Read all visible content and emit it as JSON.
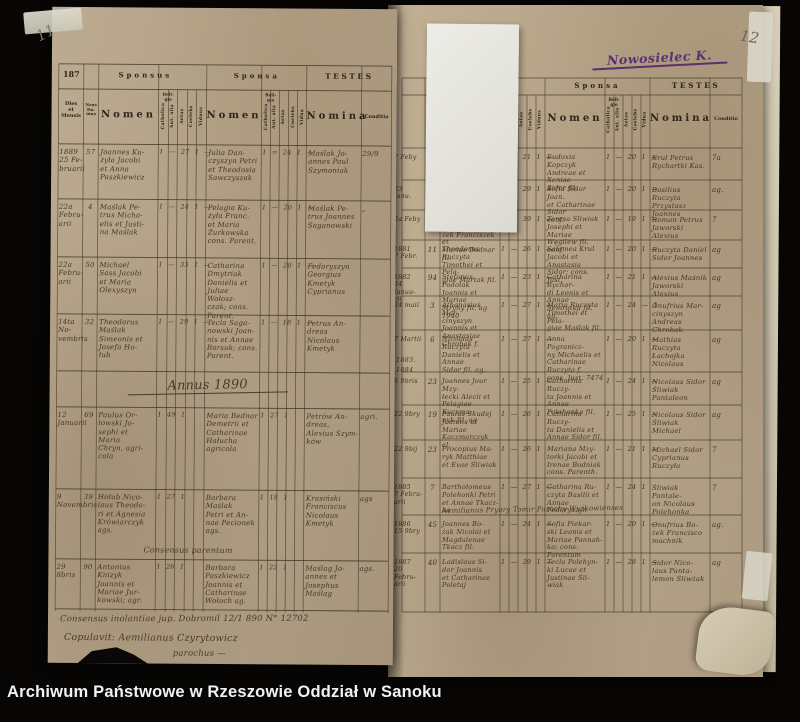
{
  "archive_bar": {
    "text": "Archiwum Państwowe w Rzeszowie Oddział w Sanoku"
  },
  "annotations": {
    "page_number_left": "11",
    "page_number_right": "12",
    "village_note": "Nowosielec K."
  },
  "left_page": {
    "header": {
      "year": "187",
      "sponsus": "Sponsus",
      "sponsa": "Sponsa",
      "testes": "TESTES",
      "dies": "Dies\net\nMensis",
      "nrus": "Nrus\nDo-\nmus",
      "nomen": "Nomen",
      "religio": "Reli-\ngio",
      "nomina": "Nomina",
      "conditio": "Conditio",
      "catholica": "Catholica",
      "aut_alia": "Aut. alia",
      "aetas": "Aetas",
      "coelebs": "Coelebs",
      "viduus": "Viduus",
      "vidua": "Vidua"
    },
    "section_heading": "Annus 1890",
    "rows": [
      {
        "date": "1889\n25 Fe-\nbruarii",
        "house": "57",
        "groom": "Joannes Ku-\nżyła Jacobi\net Anna\nPaszkiewicz",
        "groom_marks": "1 — 27 1 —",
        "bride": "Julia Dan-\nczyszyn Petri\net Theodosia\nSawczyszak",
        "bride_marks": "1 = 24 1 —",
        "witnesses": "Maślak Jo-\nannes Paul\nSzymoniak",
        "conditio": "29/9"
      },
      {
        "date": "22a\nFebru-\narii",
        "house": "4",
        "groom": "Maślak Pe-\ntrus Micha-\nelis et Justi-\nna Maślak",
        "groom_marks": "1 — 24 1 —",
        "bride": "Pelagia Ku-\nżyła Franc.\net Maria\nŻurkowska\ncons. Parent.",
        "bride_marks": "1 — 20 1 —",
        "witnesses": "Maślak Pe-\ntrus Joannes\nSaganowski",
        "conditio": "„"
      },
      {
        "date": "22a\nFebru-\narii",
        "house": "50",
        "groom": "Michael\nSass Jacobi\net Maria\nOlexyszyn",
        "groom_marks": "1 — 33 1 —",
        "bride": "Catharina\nDmytriak\nDanielis et\nJuliae Wołosz-\nczak; cons. Parent.",
        "bride_marks": "1 — 20 1 —",
        "witnesses": "Fedoryszyn\nGeorgius\nKmetyk\nCyprianus",
        "conditio": ""
      },
      {
        "date": "14ta No-\nvembris",
        "house": "32",
        "groom": "Theodorus\nMaślak\nSimeonis et\nJosefa Ho-\nłub",
        "groom_marks": "1 — 29 1 —",
        "bride": "Tecla Saga-\nnowski Joan-\nnis et Annae\nBorsuk; cons. Parent.",
        "bride_marks": "1 — 18 1 —",
        "witnesses": "Petrus An-\ndreas Nicolaus\nKmetyk",
        "conditio": ""
      },
      {
        "date": "12\nJanuarii",
        "house": "69",
        "groom": "Paulus Or-\nłowski Jo-\nsephi et\nMaria\nChryn, agri-\ncola",
        "groom_marks": "1   49  1",
        "bride": "Maria Bednar\nDemetrii et\nCatharinae\nHałucha\nagricola",
        "bride_marks": "1   27  1",
        "witnesses": "Petrów An-\ndreas,\nAlexius Szym-\nków",
        "conditio": "agri."
      },
      {
        "date": "9\nNovembris",
        "house": "39",
        "groom": "Hołub Nico-\nlaus Theodo-\nri et Agnesia\nKrówiarczyk\nags.",
        "groom_marks": "1   27  1",
        "bride": "Barbara\nMaślak\nPetri et An-\nnae Pecionek\nags.",
        "bride_marks": "1   18  1",
        "witnesses": "Krasiński\nFranciscus\nNicolaus\nKmetyk",
        "conditio": "ags"
      },
      {
        "date": "29\n8bris",
        "house": "90",
        "groom": "Antonius\nKnizyk\nJoannis et\nMariae Jur-\nkowski; agr.",
        "groom_marks": "1   26  1",
        "bride": "Barbara\nPaszkiewicz\nJoannis et\nCatharinae\nWołoch ag.",
        "bride_marks": "1   22  1",
        "witnesses": "Maślag Jo-\nannes et\nJosephus\nMaślag",
        "conditio": "ags."
      }
    ],
    "notes": {
      "consensus_interline": "Consensus parentum",
      "consensus_line": "Consensus inolantiae jup. Dobromil 12/1 890 N° 12702",
      "copulavit_line": "Copulavit: Aemilianus Czyrytowicz",
      "copulavit_line2": "parochus  —"
    }
  },
  "right_page": {
    "header": {
      "sponsa": "Sponsa",
      "testes": "TESTES",
      "nomen": "Nomen",
      "religio": "Reli-\ngio",
      "nomina": "Nomina",
      "conditio": "Conditio",
      "catholica": "Catholica",
      "aut_alia": "Aut. alia",
      "aetas": "Aetas",
      "coelebs": "Coelebs",
      "viduus": "Viduus",
      "vidua": "Vidua"
    },
    "year_markers": {
      "y1": "1883.",
      "y2": "1884."
    },
    "note_line": "Aemilianus Pryory Tomir Parochy Wyżkowienses",
    "rows": [
      {
        "date": "7 Feby",
        "house": "29",
        "groom": "Martinus Fendak\nAntonii et Mariae\nFrask fil. agr",
        "groom_marks": "1 — 21 1 —",
        "bride": "Eudoxia Kopczyk\nAndreae et Xeniae\nSidor fil.",
        "bride_marks": "1 — 20 1 —",
        "witnesses": "Krul Petrus\nRychartki Kas.",
        "conditio": "7a"
      },
      {
        "date": "23\nJanu.",
        "house": "14",
        "groom": "Pantaleon Śliw-\nniak Theodori et\nAnnae Sidor fil. ag",
        "groom_marks": "1 — 29 1 —",
        "bride": "Sofia Sidor Joan.\net Catharinae Sidor\nconf.",
        "bride_marks": "1 — 20 1 —",
        "witnesses": "Basilius Ruczyta\nPrzystasz Joannes",
        "conditio": "ag."
      },
      {
        "date": "2a Feby",
        "house": "14",
        "groom": "Constantinus Bo-\nżek Franciszek et\nMariae Bodnar fil.",
        "groom_marks": "1 — 39 1 —",
        "bride": "Teresa Śliwiak\nJosephi et Mariae\nWęgilew fil. conf.",
        "bride_marks": "1 — 19 1 —",
        "witnesses": "Roman Petrus\nJaworski Alexius",
        "conditio": "7"
      },
      {
        "date": "1881\n7 Febr.",
        "house": "11",
        "groom": "Theodorus Ruczyta\nTimothei et Pela-\ngiae Martak fil.",
        "groom_marks": "1 — 26 1 —",
        "bride": "Salomea Krul\nJacobi et Anastasia\nSidor; cons. Just.",
        "bride_marks": "1 — 20 1 —",
        "witnesses": "Ruczyta Daniel\nSidor Joannes",
        "conditio": "ag"
      },
      {
        "date": "1882\n24 Janua-\nrii",
        "house": "94",
        "groom": "Stefanus Podolak\nJoannis et Mariae\nMryhy fil. ag 1940",
        "groom_marks": "1 — 23 1 —",
        "bride": "Catharina Rychar-\ndi Leonis et Annae\nSemrotka fil. ag.",
        "bride_marks": "1 — 21 1 —",
        "witnesses": "Alexius Maśnik\nJaworski Alexius",
        "conditio": "ag"
      },
      {
        "date": "24 maii",
        "house": "3",
        "groom": "Athanasius Mar-\ncinyszyn Joannis et\nAnastasiae Chrobak f.",
        "groom_marks": "1 — 27 1 —",
        "bride": "Maria Ruczyta\nTimothei et Pela-\ngiae Maślak fil.",
        "bride_marks": "1 — 24 — 1",
        "witnesses": "Onufrius Mar-\ncinyszyn Andreas\nChrobak",
        "conditio": "ag"
      },
      {
        "date": "7 Martii",
        "house": "6",
        "groom": "Nicolaus Ruczyta\nDanielis et Annae\nSidor fil. ag.",
        "groom_marks": "1 — 27 1 —",
        "bride": "Anna Pogranicz-\nny Michaelis et\nCatharinae Ruczyta f.\ncons. Just. 7474",
        "bride_marks": "1 — 20 1 —",
        "witnesses": "Mathias Ruczyta\nŁachojka Nicolaus",
        "conditio": "ag"
      },
      {
        "date": "6 9bris",
        "house": "23",
        "groom": "Joannes Jour Mzy-\nłecki Alecii et\nPelagiae Kuczma-\nnyk fil. ag",
        "groom_marks": "1 — 25 1 —",
        "bride": "Catharina Ruczy-\nta Joannis et Annae\nPolehonka fil.",
        "bride_marks": "1 — 24 1 —",
        "witnesses": "Nicolaus Sidor\nŚliwiak Pantaleon",
        "conditio": "ag"
      },
      {
        "date": "22 9bry",
        "house": "19",
        "groom": "Paulus Skudej\nJoannis et Mariae\nKaczmarczyk el.",
        "groom_marks": "1 — 26 1",
        "bride": "Catharina Ruczy-\nta Danielis et\nAnnae Sidor fil.",
        "bride_marks": "1 — 25 1 —",
        "witnesses": "Nicolaus Sidor\nŚliwiak Michael",
        "conditio": "ag"
      },
      {
        "date": "22 9bij",
        "house": "23",
        "groom": "Procopius Ma-\nryk Matthiae\net Evae Śliwiak",
        "groom_marks": "1 — 26 1",
        "bride": "Mariana Mzy-\ntorki Jacobi et\nIrenae Bodniak\ncons. Parenth.",
        "bride_marks": "1 — 21 1 —",
        "witnesses": "Michael Sidor\nCyprianus Ruczyła",
        "conditio": "7"
      },
      {
        "date": "1885\n7 Febru-\narii",
        "house": "7",
        "groom": "Bartholomeus\nPolehonki Petri\net Annae Tkacz-\nka",
        "groom_marks": "1 — 27 1 —",
        "bride": "Catharina Ru-\nczyta Basilii et\nAnnae Fedoryszyn",
        "bride_marks": "1 — 24 1",
        "witnesses": "Śliwiak Pantale-\non Nicolaus\nPolehonka",
        "conditio": "7"
      },
      {
        "date": "1886\n15 9bry",
        "house": "45",
        "groom": "Joannes Bo-\nżak Nicolai et\nMagdalenae\nTkacz fil.",
        "groom_marks": "1 — 24 1 —",
        "bride": "Sofia Piekar-\nski Leonis et\nMariae Pannah-\nka; cons. Parentum",
        "bride_marks": "1 — 20 1 —",
        "witnesses": "Onufrius Bo-\nżek Francisco\nmachnik",
        "conditio": "ag."
      },
      {
        "date": "1887\n20 Febru-\narii",
        "house": "40",
        "groom": "Ladislaus Si-\ndor Joannis\net Catharinae\nPoletaj",
        "groom_marks": "1 — 29 1 —",
        "bride": "Tecla Polehyn-\nki Lucae et\nJustinae Śli-\nwiak",
        "bride_marks": "1 — 28 1 —",
        "witnesses": "Sidor Nico-\nlaus Panta-\nlemon Śliwżak",
        "conditio": "ag"
      }
    ]
  }
}
